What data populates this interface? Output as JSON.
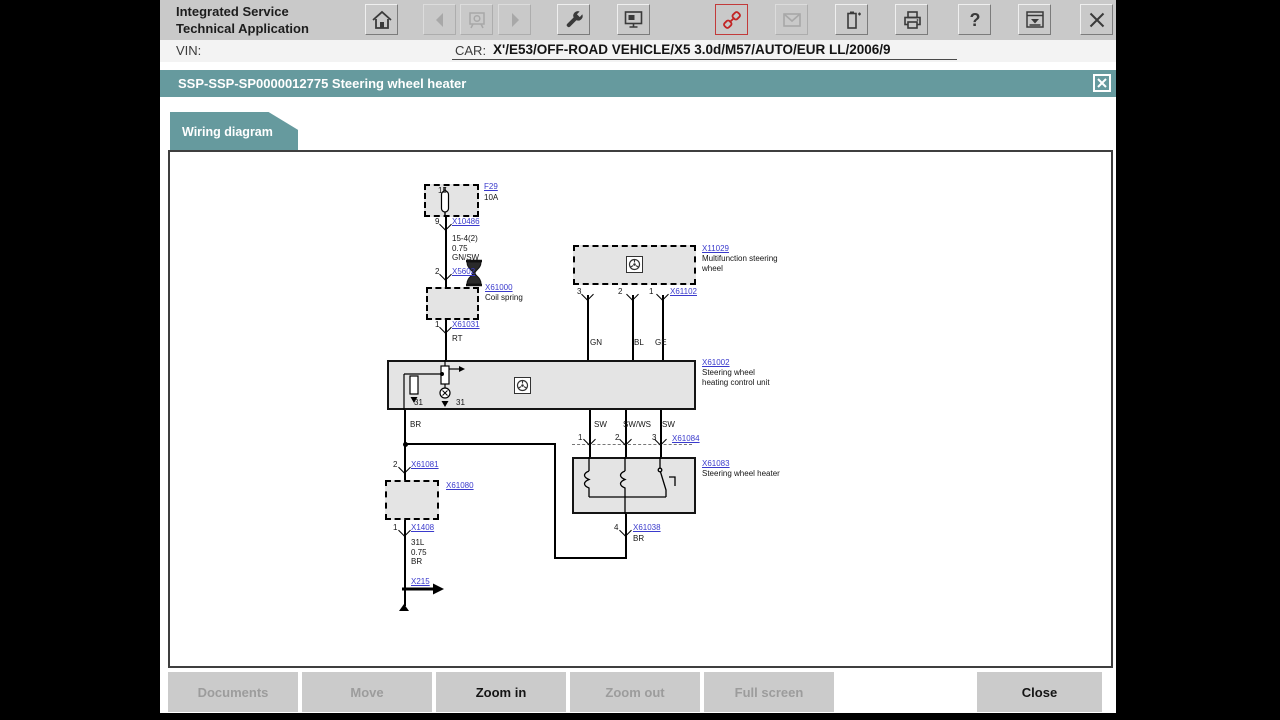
{
  "colors": {
    "teal": "#669a9e",
    "accent_red": "#c22424",
    "toolbar_gray": "#c9c9c9"
  },
  "window": {
    "app_title_line1": "Integrated Service",
    "app_title_line2": "Technical Application",
    "vin_label": "VIN:",
    "car_label": "CAR:",
    "car_value": "X'/E53/OFF-ROAD VEHICLE/X5 3.0d/M57/AUTO/EUR LL/2006/9"
  },
  "toolbar": {
    "buttons": [
      {
        "icon": "home",
        "enabled": true
      },
      {
        "icon": "back",
        "enabled": false
      },
      {
        "icon": "workshop",
        "enabled": false
      },
      {
        "icon": "forward",
        "enabled": false
      },
      {
        "icon": "wrench",
        "enabled": true
      },
      {
        "icon": "display",
        "enabled": true
      },
      {
        "icon": "connector",
        "enabled": true,
        "accent": true
      },
      {
        "icon": "mail",
        "enabled": false
      },
      {
        "icon": "battery",
        "enabled": true
      },
      {
        "icon": "printer",
        "enabled": true
      },
      {
        "icon": "help",
        "enabled": true
      },
      {
        "icon": "window-selector",
        "enabled": true
      },
      {
        "icon": "close",
        "enabled": true
      }
    ]
  },
  "title_bar": {
    "text": "SSP-SSP-SP0000012775 Steering wheel heater"
  },
  "tab": {
    "label": "Wiring diagram"
  },
  "footer": {
    "buttons": [
      {
        "label": "Documents",
        "enabled": false
      },
      {
        "label": "Move",
        "enabled": false
      },
      {
        "label": "Zoom in",
        "enabled": true
      },
      {
        "label": "Zoom out",
        "enabled": false
      },
      {
        "label": "Full screen",
        "enabled": false
      },
      {
        "label": "Close",
        "enabled": true
      }
    ]
  },
  "diagram": {
    "boxes": [
      {
        "name": "fuse-box",
        "x": 254,
        "y": 32,
        "w": 55,
        "h": 33,
        "dashed": true
      },
      {
        "name": "coil-spring-1-box",
        "x": 256,
        "y": 135,
        "w": 53,
        "h": 33,
        "dashed": true
      },
      {
        "name": "multifunction-steering-wheel-box",
        "x": 403,
        "y": 93,
        "w": 123,
        "h": 40,
        "dashed": true
      },
      {
        "name": "control-unit-box",
        "x": 217,
        "y": 208,
        "w": 309,
        "h": 50,
        "dashed": false
      },
      {
        "name": "steering-wheel-heater-box",
        "x": 402,
        "y": 305,
        "w": 124,
        "h": 57,
        "dashed": false
      },
      {
        "name": "coil-spring-2-box",
        "x": 215,
        "y": 328,
        "w": 54,
        "h": 40,
        "dashed": true
      }
    ],
    "wires": [
      [
        275,
        65,
        275,
        208
      ],
      [
        234,
        258,
        234,
        452
      ],
      [
        234,
        291,
        384,
        291
      ],
      [
        384,
        291,
        384,
        405
      ],
      [
        384,
        405,
        455,
        405
      ],
      [
        455,
        362,
        455,
        405
      ],
      [
        417,
        143,
        417,
        208
      ],
      [
        462,
        143,
        462,
        208
      ],
      [
        492,
        143,
        492,
        208
      ],
      [
        419,
        258,
        419,
        305
      ],
      [
        455,
        258,
        455,
        305
      ],
      [
        490,
        258,
        490,
        305
      ]
    ],
    "pins": [
      [
        275,
        72
      ],
      [
        275,
        122
      ],
      [
        275,
        175
      ],
      [
        417,
        142
      ],
      [
        462,
        142
      ],
      [
        492,
        142
      ],
      [
        419,
        287
      ],
      [
        455,
        287
      ],
      [
        490,
        287
      ],
      [
        455,
        378
      ],
      [
        234,
        315
      ],
      [
        234,
        378
      ]
    ],
    "dots": [
      [
        234,
        291
      ]
    ],
    "links": [
      {
        "t": "F29",
        "x": 314,
        "y": 30
      },
      {
        "t": "X10486",
        "x": 282,
        "y": 65
      },
      {
        "t": "X5602",
        "x": 282,
        "y": 115
      },
      {
        "t": "X61000",
        "x": 315,
        "y": 131
      },
      {
        "t": "X61031",
        "x": 282,
        "y": 168
      },
      {
        "t": "X11029",
        "x": 532,
        "y": 92
      },
      {
        "t": "X61102",
        "x": 500,
        "y": 135
      },
      {
        "t": "X61002",
        "x": 532,
        "y": 206
      },
      {
        "t": "X61084",
        "x": 502,
        "y": 282
      },
      {
        "t": "X61083",
        "x": 532,
        "y": 307
      },
      {
        "t": "X61038",
        "x": 463,
        "y": 371
      },
      {
        "t": "X61081",
        "x": 241,
        "y": 308
      },
      {
        "t": "X61080",
        "x": 276,
        "y": 329
      },
      {
        "t": "X1408",
        "x": 241,
        "y": 371
      },
      {
        "t": "X215",
        "x": 241,
        "y": 425
      }
    ],
    "texts": [
      {
        "t": "10A",
        "x": 314,
        "y": 41
      },
      {
        "t": "15",
        "x": 268,
        "y": 34
      },
      {
        "t": "15-4(2)\n0.75\nGN/SW",
        "x": 282,
        "y": 82
      },
      {
        "t": "Coil spring",
        "x": 315,
        "y": 141
      },
      {
        "t": "RT",
        "x": 282,
        "y": 182
      },
      {
        "t": "Multifunction steering\nwheel",
        "x": 532,
        "y": 102
      },
      {
        "t": "GN",
        "x": 420,
        "y": 186
      },
      {
        "t": "BL",
        "x": 464,
        "y": 186
      },
      {
        "t": "GE",
        "x": 485,
        "y": 186
      },
      {
        "t": "Steering wheel\nheating control unit",
        "x": 532,
        "y": 216
      },
      {
        "t": "BR",
        "x": 240,
        "y": 268
      },
      {
        "t": "31",
        "x": 244,
        "y": 246
      },
      {
        "t": "31",
        "x": 286,
        "y": 246
      },
      {
        "t": "SW",
        "x": 424,
        "y": 268
      },
      {
        "t": "SW/WS",
        "x": 453,
        "y": 268
      },
      {
        "t": "SW",
        "x": 492,
        "y": 268
      },
      {
        "t": "Steering wheel heater",
        "x": 532,
        "y": 317
      },
      {
        "t": "BR",
        "x": 463,
        "y": 382
      },
      {
        "t": "31L\n0.75\nBR",
        "x": 241,
        "y": 386
      },
      {
        "t": "9",
        "x": 265,
        "y": 65
      },
      {
        "t": "2",
        "x": 265,
        "y": 115
      },
      {
        "t": "1",
        "x": 265,
        "y": 168
      },
      {
        "t": "3",
        "x": 407,
        "y": 135
      },
      {
        "t": "2",
        "x": 448,
        "y": 135
      },
      {
        "t": "1",
        "x": 479,
        "y": 135
      },
      {
        "t": "1",
        "x": 408,
        "y": 281
      },
      {
        "t": "2",
        "x": 445,
        "y": 281
      },
      {
        "t": "3",
        "x": 482,
        "y": 281
      },
      {
        "t": "4",
        "x": 444,
        "y": 371
      },
      {
        "t": "2",
        "x": 223,
        "y": 308
      },
      {
        "t": "1",
        "x": 223,
        "y": 371
      }
    ],
    "symbols": [
      {
        "type": "fuse",
        "x": 266,
        "y": 35
      },
      {
        "type": "wheel",
        "x": 456,
        "y": 104
      },
      {
        "type": "wheel",
        "x": 344,
        "y": 225
      },
      {
        "type": "cu-internals",
        "x": 228,
        "y": 208
      },
      {
        "type": "heater-internals",
        "x": 402,
        "y": 305
      },
      {
        "type": "dashed-connector",
        "x": 402,
        "y": 292
      },
      {
        "type": "ground-arrow",
        "x": 230,
        "y": 430
      },
      {
        "type": "ground-end",
        "x": 228,
        "y": 447
      },
      {
        "type": "cursor",
        "x": 293,
        "y": 107
      }
    ]
  }
}
